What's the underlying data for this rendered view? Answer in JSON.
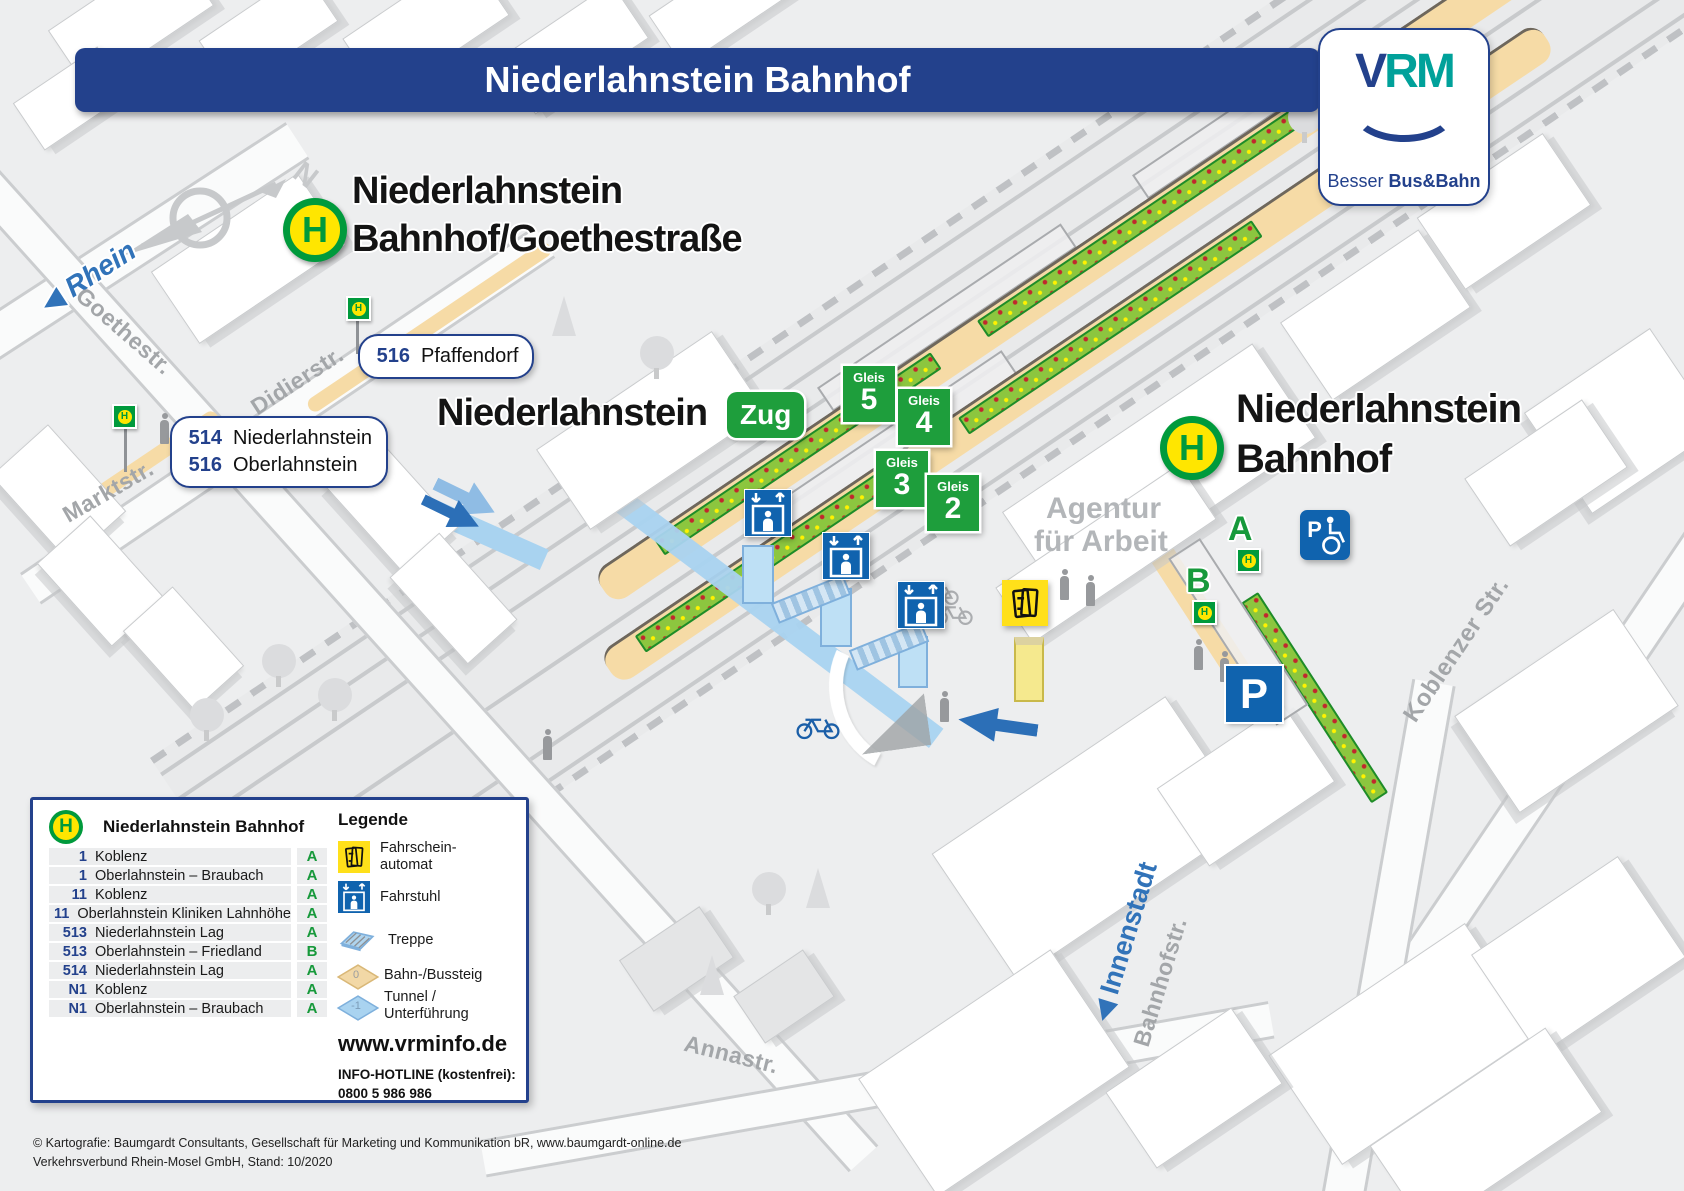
{
  "header": {
    "title": "Niederlahnstein Bahnhof"
  },
  "logo": {
    "v": "V",
    "rm": "RM",
    "tagline_regular": "Besser",
    "tagline_bold": "Bus&Bahn"
  },
  "map": {
    "north": "N",
    "direction_arrow": "◀",
    "h_letter": "H",
    "rhein": "Rhein",
    "innenstadt": "Innenstadt",
    "streets": {
      "goethe": "Goethestr.",
      "didier": "Didierstr.",
      "markt": "Marktstr.",
      "koblenzer": "Koblenzer Str.",
      "bahnhof": "Bahnhofstr.",
      "anna": "Annastr."
    },
    "agentur_line1": "Agentur",
    "agentur_line2": "für Arbeit",
    "stop_goethe": {
      "line1": "Niederlahnstein",
      "line2": "Bahnhof/Goethestraße"
    },
    "stop_zug": {
      "name": "Niederlahnstein",
      "badge": "Zug"
    },
    "stop_bahnhof": {
      "line1": "Niederlahnstein",
      "line2": "Bahnhof"
    },
    "gleis_label": "Gleis",
    "gleis": [
      {
        "number": "5"
      },
      {
        "number": "4"
      },
      {
        "number": "3"
      },
      {
        "number": "2"
      }
    ],
    "bays": {
      "a": "A",
      "b": "B"
    },
    "parking": "P",
    "route_box_1": {
      "number": "516",
      "destination": "Pfaffendorf"
    },
    "route_box_2": {
      "rows": [
        {
          "number": "514",
          "destination": "Niederlahnstein"
        },
        {
          "number": "516",
          "destination": "Oberlahnstein"
        }
      ]
    }
  },
  "legend_panel": {
    "stop_title": "Niederlahnstein Bahnhof",
    "departures": [
      {
        "line": "1",
        "destination": "Koblenz",
        "bay": "A"
      },
      {
        "line": "1",
        "destination": "Oberlahnstein – Braubach",
        "bay": "A"
      },
      {
        "line": "11",
        "destination": "Koblenz",
        "bay": "A"
      },
      {
        "line": "11",
        "destination": "Oberlahnstein Kliniken Lahnhöhe",
        "bay": "A"
      },
      {
        "line": "513",
        "destination": "Niederlahnstein Lag",
        "bay": "A"
      },
      {
        "line": "513",
        "destination": "Oberlahnstein – Friedland",
        "bay": "B"
      },
      {
        "line": "514",
        "destination": "Niederlahnstein Lag",
        "bay": "A"
      },
      {
        "line": "N1",
        "destination": "Koblenz",
        "bay": "A"
      },
      {
        "line": "N1",
        "destination": "Oberlahnstein – Braubach",
        "bay": "A"
      }
    ],
    "legende_title": "Legende",
    "items": {
      "ticket": {
        "line1": "Fahrschein-",
        "line2": "automat"
      },
      "elevator": {
        "label": "Fahrstuhl"
      },
      "stairs": {
        "label": "Treppe"
      },
      "platform": {
        "label": "Bahn-/Bussteig",
        "level": "0"
      },
      "tunnel": {
        "line1": "Tunnel /",
        "line2": "Unterführung",
        "level": "-1"
      }
    },
    "website": "www.vrminfo.de",
    "hotline_label": "INFO-HOTLINE (kostenfrei):",
    "hotline_number": "0800 5 986 986"
  },
  "footer": {
    "line1": "© Kartografie: Baumgardt Consultants, Gesellschaft für Marketing und Kommunikation bR, www.baumgardt-online.de",
    "line2": "Verkehrsverbund Rhein-Mosel GmbH, Stand: 10/2020"
  },
  "colors": {
    "title_blue": "#23418C",
    "sign_green": "#1E9E3C",
    "stop_green": "#009A3C",
    "stop_yellow": "#FFE600",
    "icon_blue": "#1063AE",
    "ticket_yellow": "#FFE01A",
    "platform_tan": "#F6DBA6",
    "tunnel_blue": "#A9D3F0",
    "bed_green": "#8CC63F",
    "vrm_teal": "#00A19A",
    "direction_blue": "#3173B9"
  },
  "icons": {
    "h_stop": "circle-H",
    "elevator": "person-in-box + up/down arrows",
    "ticket_machine": "double-ticket outline",
    "stairs": "isometric steps",
    "platform_diamond": "tan diamond 0",
    "tunnel_diamond": "blue diamond -1",
    "wheelchair_parking": "P + wheelchair",
    "parking": "P",
    "compass": "needle + N",
    "bicycle": "two wheels + frame",
    "direction_arrow": "◀"
  }
}
